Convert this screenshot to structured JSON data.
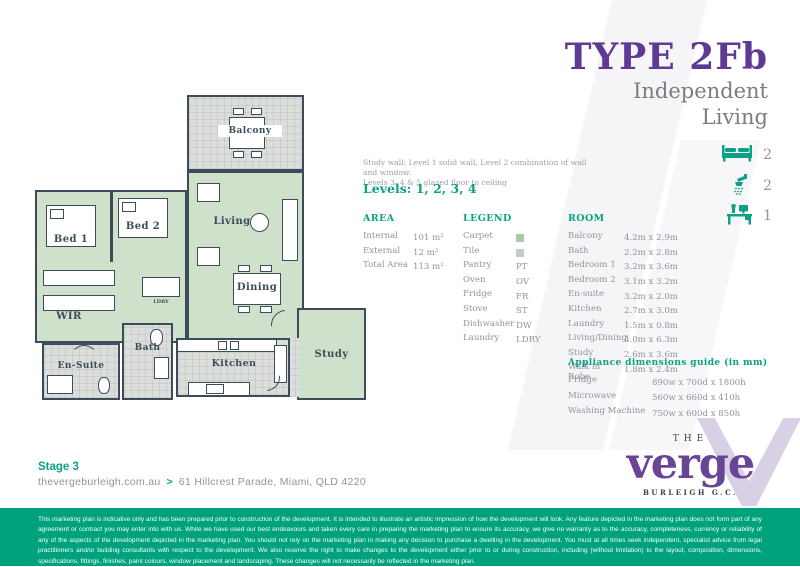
{
  "title": {
    "type": "TYPE 2Fb",
    "subtitle_line1": "Independent",
    "subtitle_line2": "Living"
  },
  "features": [
    {
      "icon": "bed-icon",
      "count": "2"
    },
    {
      "icon": "shower-icon",
      "count": "2"
    },
    {
      "icon": "desk-icon",
      "count": "1"
    }
  ],
  "study_note": {
    "line1": "Study wall: Level 1 solid wall, Level 2 combination of wall and window.",
    "line2": "Levels 3, 4 & 5 glazed floor to ceiling"
  },
  "levels_label": "Levels: 1, 2, 3, 4",
  "area": {
    "header": "AREA",
    "rows": [
      {
        "label": "Internal",
        "value": "101 m²"
      },
      {
        "label": "External",
        "value": "12 m²"
      },
      {
        "label": "Total Area",
        "value": "113 m²"
      }
    ]
  },
  "legend": {
    "header": "LEGEND",
    "rows": [
      {
        "label": "Carpet",
        "swatch": "#a5cdaa"
      },
      {
        "label": "Tile",
        "swatch": "#c7cbc9"
      },
      {
        "label": "Pantry",
        "value": "PT"
      },
      {
        "label": "Oven",
        "value": "OV"
      },
      {
        "label": "Fridge",
        "value": "FR"
      },
      {
        "label": "Stove",
        "value": "ST"
      },
      {
        "label": "Dishwasher",
        "value": "DW"
      },
      {
        "label": "Laundry",
        "value": "LDRY"
      }
    ]
  },
  "rooms": {
    "header": "ROOM",
    "rows": [
      {
        "label": "Balcony",
        "value": "4.2m x 2.9m"
      },
      {
        "label": "Bath",
        "value": "2.2m x 2.8m"
      },
      {
        "label": "Bedroom 1",
        "value": "3.2m x 3.6m"
      },
      {
        "label": "Bedroom 2",
        "value": "3.1m x 3.2m"
      },
      {
        "label": "En-suite",
        "value": "3.2m x 2.0m"
      },
      {
        "label": "Kitchen",
        "value": "2.7m x 3.0m"
      },
      {
        "label": "Laundry",
        "value": "1.5m x 0.8m"
      },
      {
        "label": "Living/Dining",
        "value": "4.0m x 6.3m"
      },
      {
        "label": "Study",
        "value": "2.6m x 3.6m"
      },
      {
        "label": "Walk in Robe",
        "value": "1.8m x 2.4m"
      }
    ]
  },
  "appliances": {
    "header": "Appliance dimensions guide (in mm)",
    "rows": [
      {
        "label": "Fridge",
        "value": "890w x 700d x 1800h"
      },
      {
        "label": "Microwave",
        "value": "560w x 660d x 410h"
      },
      {
        "label": "Washing Machine",
        "value": "750w x 600d x 850h"
      }
    ]
  },
  "plan": {
    "labels": {
      "balcony": "Balcony",
      "living": "Living",
      "dining": "Dining",
      "bed1": "Bed 1",
      "bed2": "Bed 2",
      "wir": "WIR",
      "bath": "Bath",
      "ensuite": "En-Suite",
      "kitchen": "Kitchen",
      "study": "Study",
      "ldry": "LDRY"
    }
  },
  "footer": {
    "stage": "Stage 3",
    "website": "thevergeburleigh.com.au",
    "arrow": ">",
    "address": "61 Hillcrest Parade, Miami, QLD 4220"
  },
  "logo": {
    "the": "THE",
    "name": "verge",
    "location": "BURLEIGH G.C."
  },
  "disclaimer": "This marketing plan is indicative only and has been prepared prior to construction of the development. It is intended to illustrate an artistic impression of how the development will look. Any feature depicted in the marketing plan does not form part of any agreement or contract you may enter into with us. While we have used our best endeavours and taken every care in preparing the marketing plan to ensure its accuracy, we give no warranty as to the accuracy, completeness, currency or reliability of any of the aspects of the development depicted in the marketing plan. You should not rely on the marketing plan in making any decision to purchase a dwelling in the development. You must at all times seek independent, specialist advice from legal practitioners and/or building consultants with respect to the development. We also reserve the right to make changes to the development either prior to or during construction, including (without limitation) to the layout, composition, dimensions, specifications, fittings, finishes, paint colours, window placement and landscaping. These changes will not necessarily be reflected in the marketing plan.",
  "colors": {
    "teal": "#00a17d",
    "title_purple": "#5e3a94",
    "logo_purple": "#6a4596",
    "wall": "#3d4c5a",
    "carpet": "#cfe0cb",
    "tile": "#dcdedb"
  }
}
